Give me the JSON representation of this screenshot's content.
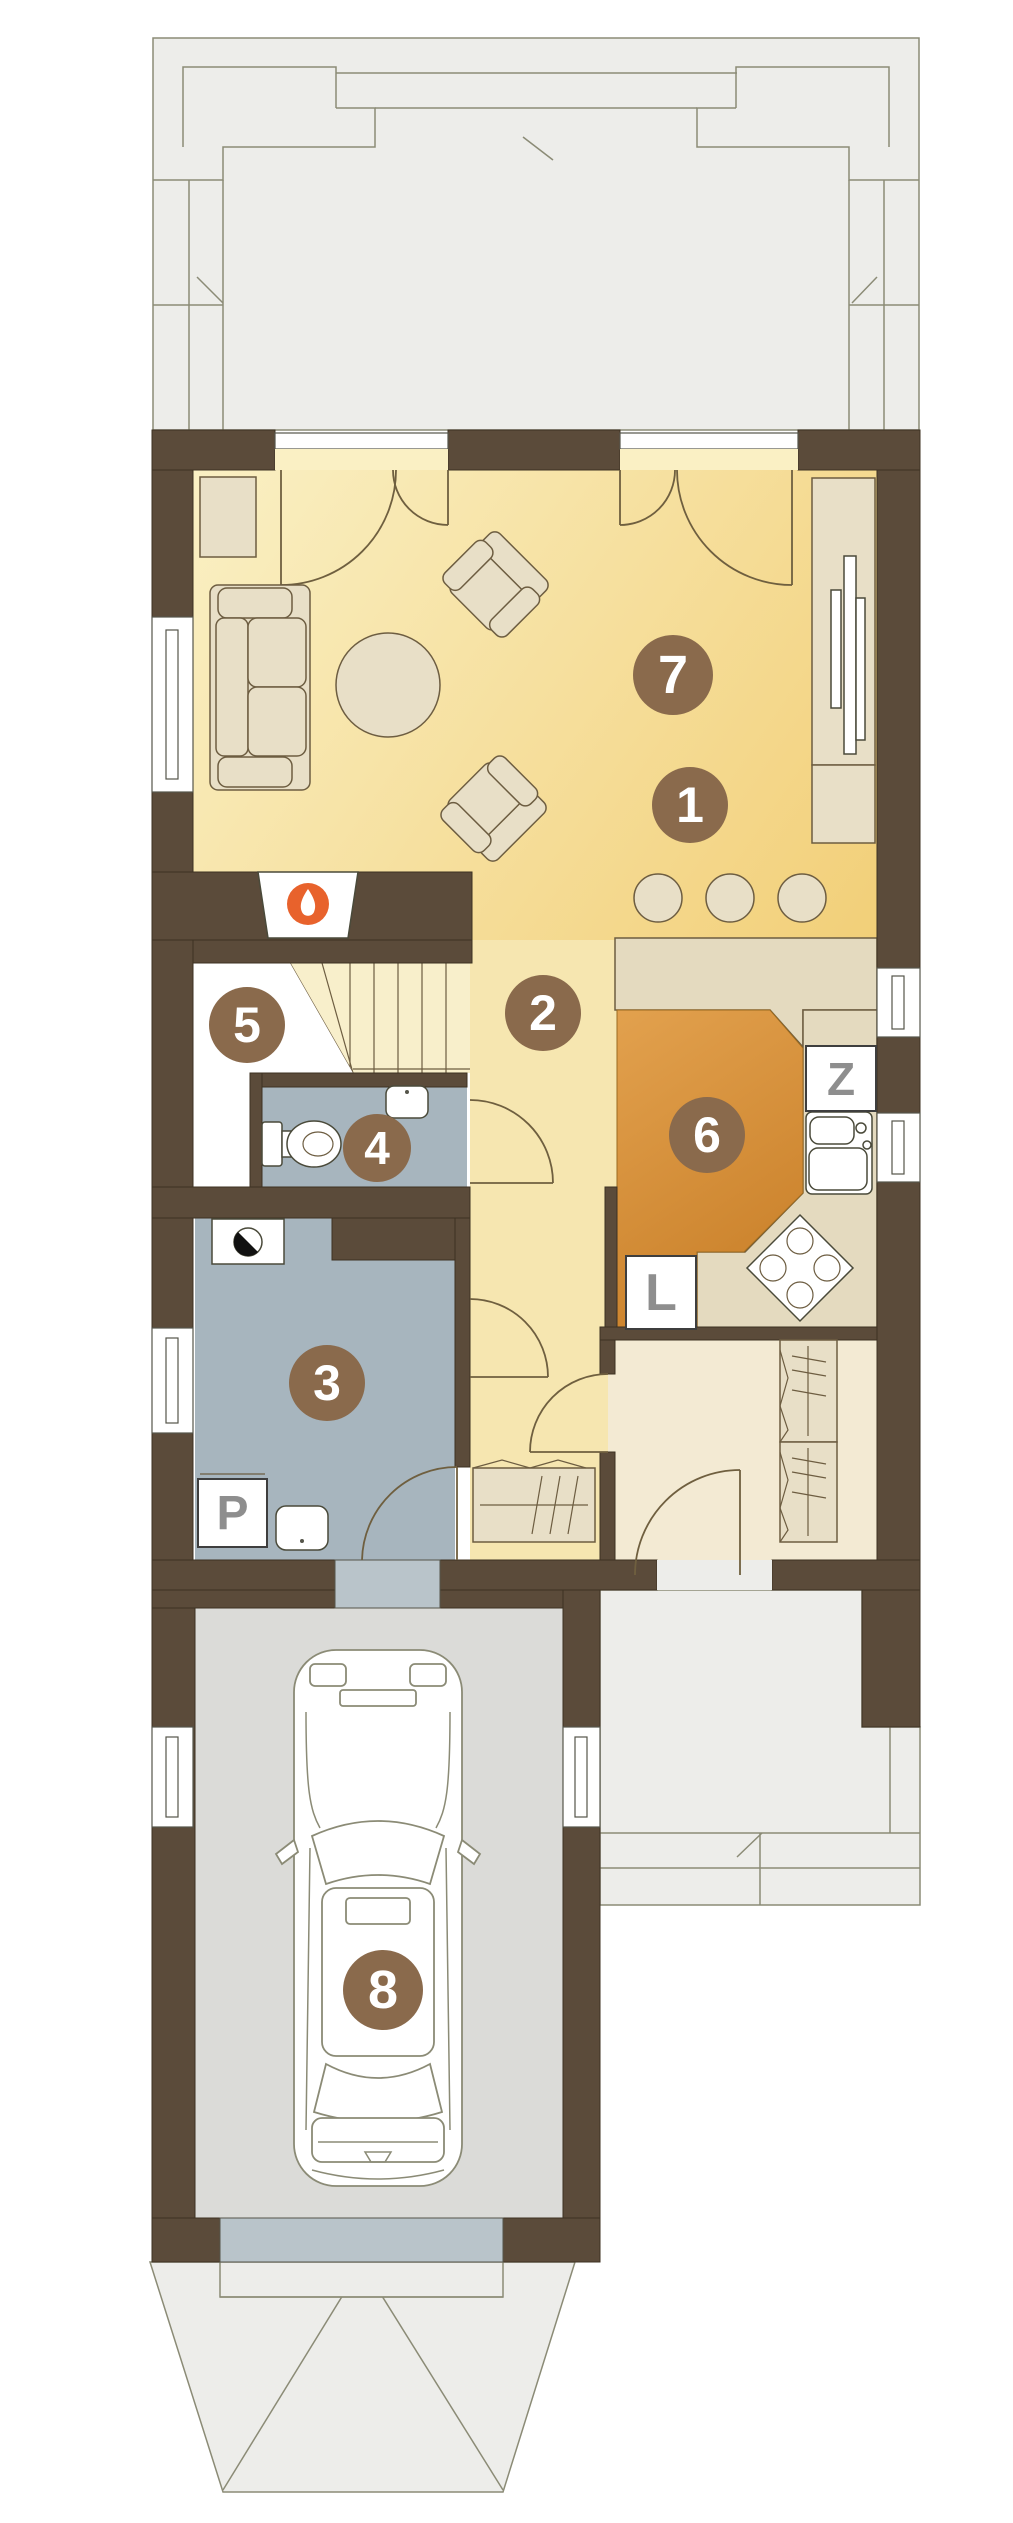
{
  "plan": {
    "type": "floor-plan",
    "markers": [
      {
        "id": "room-1",
        "label": "1"
      },
      {
        "id": "room-2",
        "label": "2"
      },
      {
        "id": "room-3",
        "label": "3"
      },
      {
        "id": "room-4",
        "label": "4"
      },
      {
        "id": "room-5",
        "label": "5"
      },
      {
        "id": "room-6",
        "label": "6"
      },
      {
        "id": "room-7",
        "label": "7"
      },
      {
        "id": "room-8",
        "label": "8"
      }
    ],
    "appliances": [
      {
        "id": "dishwasher",
        "label": "Z"
      },
      {
        "id": "fridge",
        "label": "L"
      },
      {
        "id": "washer",
        "label": "P"
      }
    ],
    "icons": [
      "fireplace-flame-icon",
      "boiler-icon",
      "toilet",
      "washbasin",
      "kitchen-sink",
      "cooktop",
      "car"
    ]
  },
  "colors": {
    "wall": "#5b4b3a",
    "wall_line": "#3c3122",
    "terrace": "#ededea",
    "outline": "#8b8b76",
    "living_light": "#faf0c4",
    "living_dark": "#f2cf78",
    "hallway": "#f6e6b0",
    "stairs": "#f8efcb",
    "room1": "#f3ead3",
    "bath": "#a7b5be",
    "kitchen_light": "#e2a14e",
    "kitchen_dark": "#c87e27",
    "counter": "#e4dabf",
    "furniture": "#e8dfc7",
    "garage": "#dbdbd8",
    "passdoor": "#b9c4ca",
    "marker": "#8a6a4c",
    "letter": "#8e8e8e",
    "flame": "#e8622c"
  }
}
